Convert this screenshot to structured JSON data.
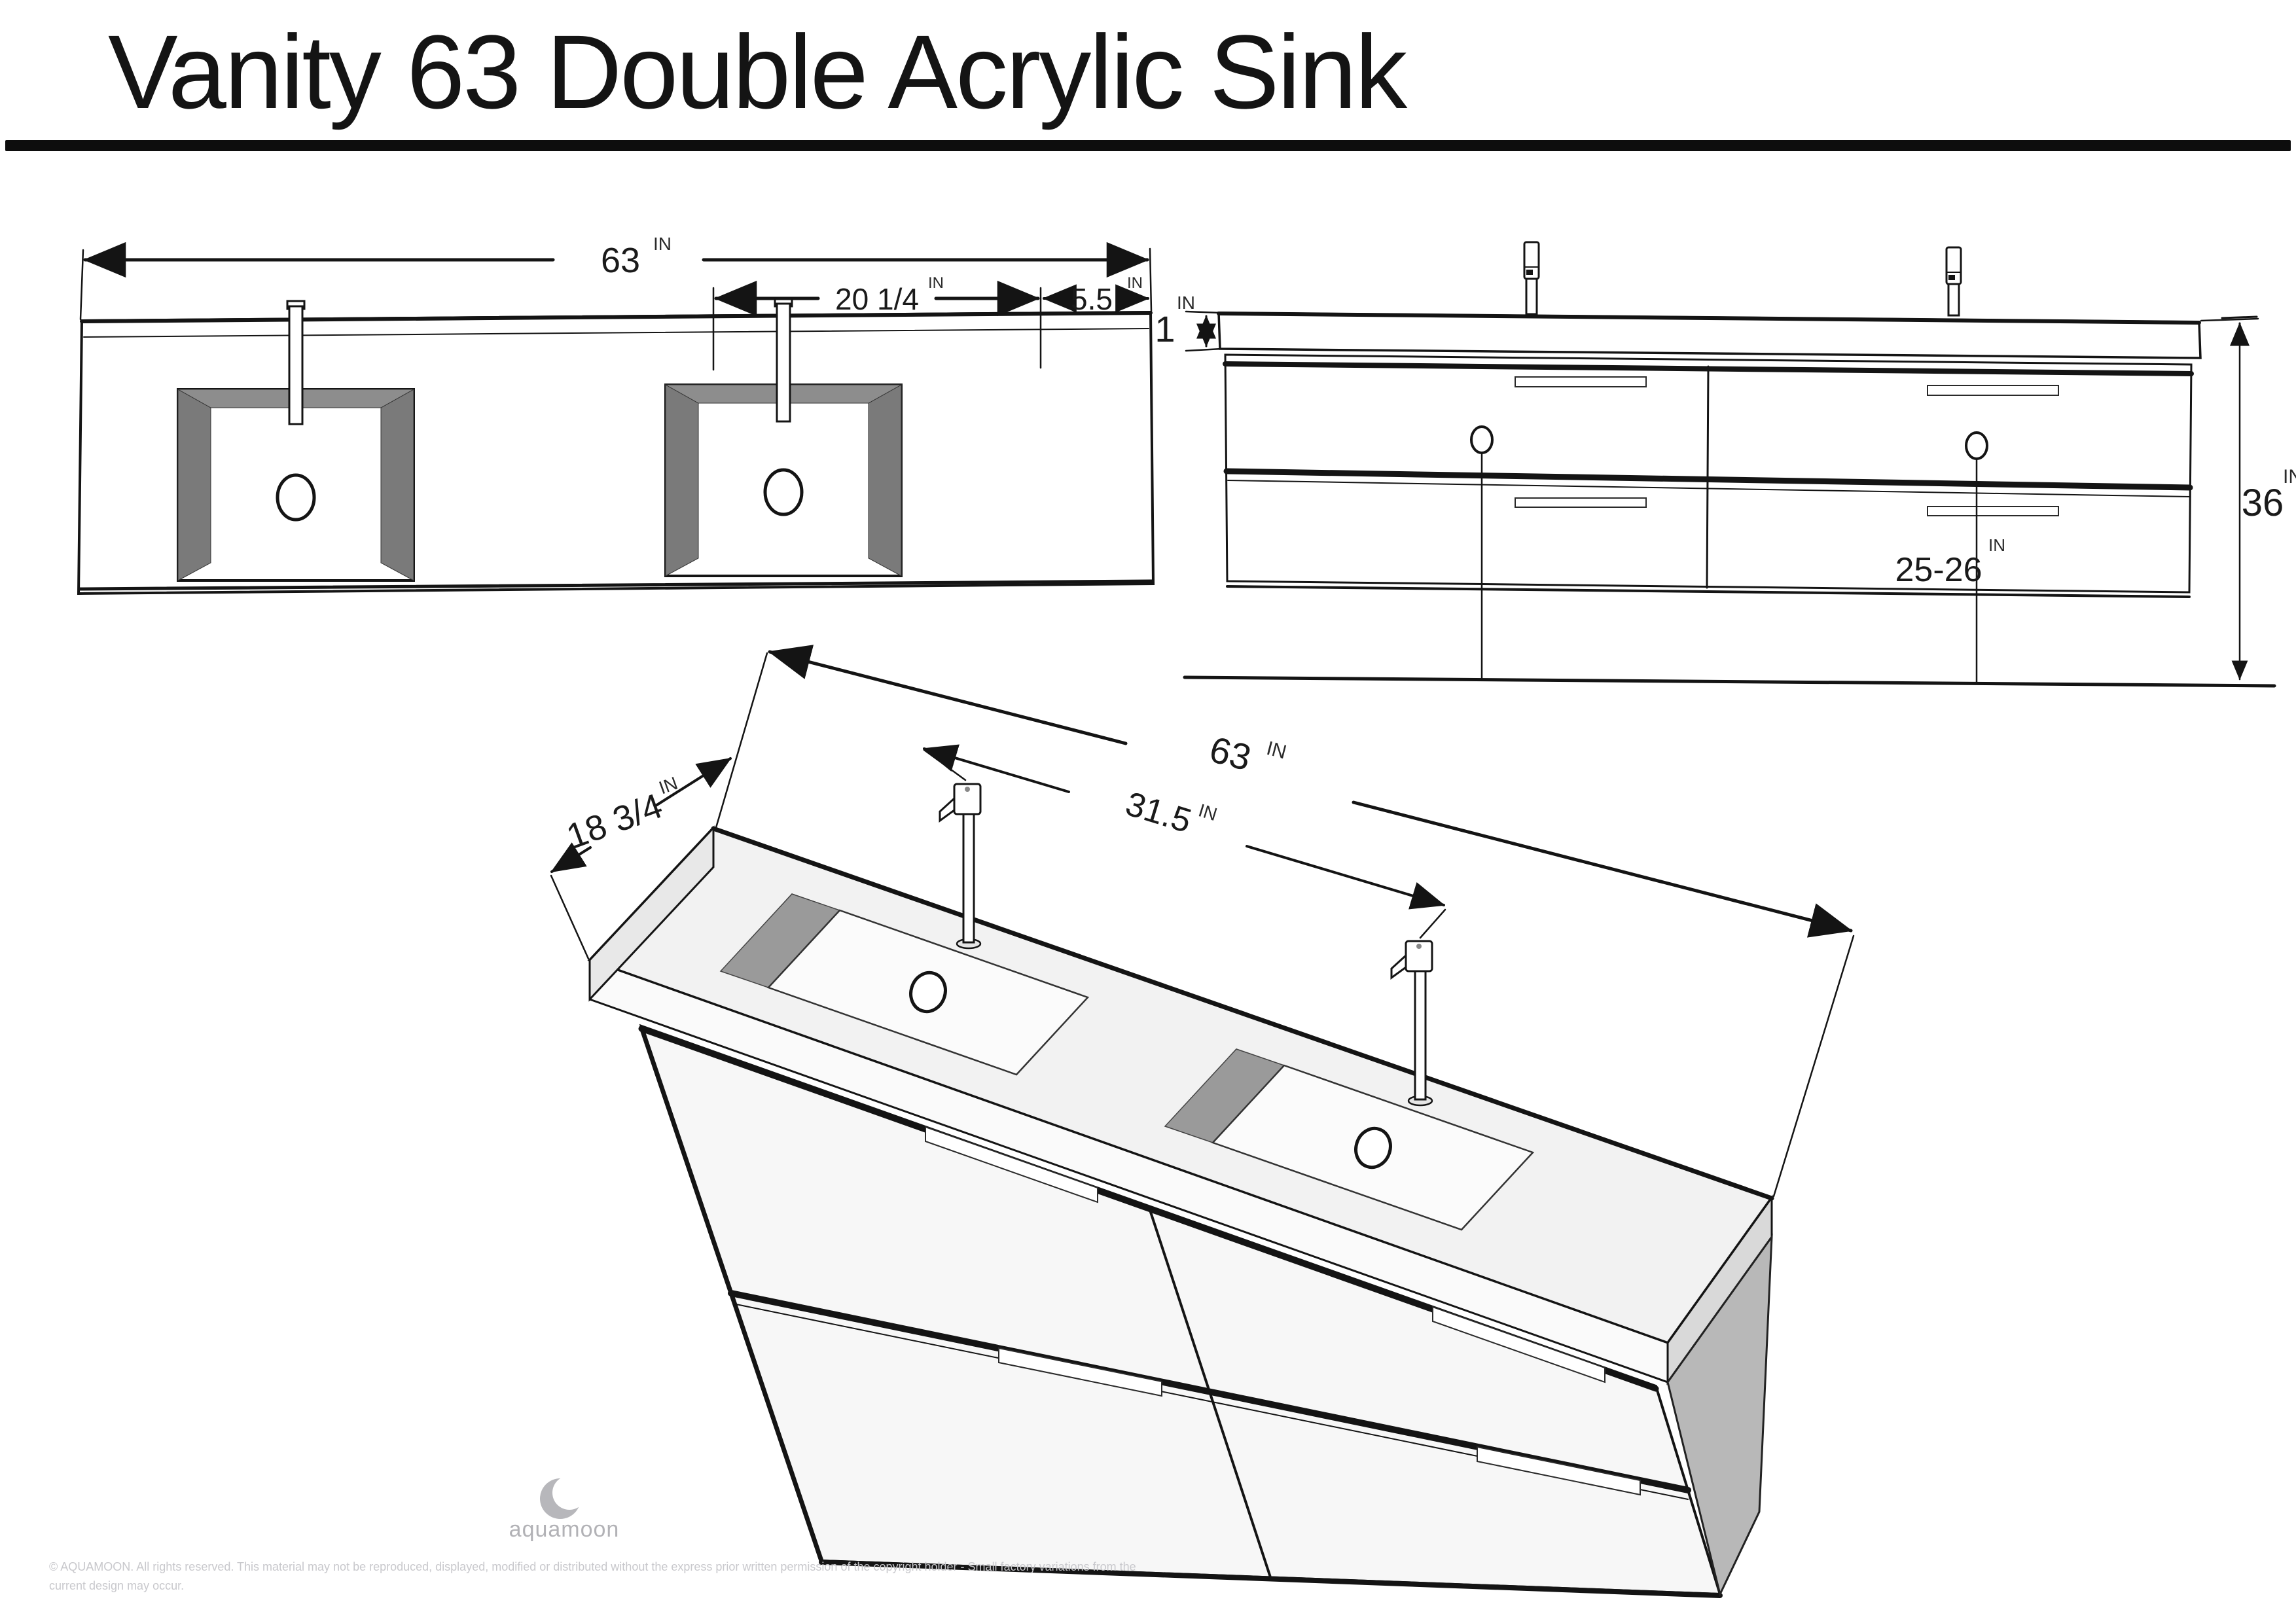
{
  "title": "Vanity 63 Double Acrylic Sink",
  "unit": "IN",
  "top_view": {
    "width": "63",
    "basin_width": "20 1/4",
    "edge_offset": "5.5"
  },
  "front_view": {
    "counter_thickness": "1",
    "height": "36",
    "drain_height": "25-26"
  },
  "perspective_view": {
    "width": "63",
    "depth": "18 3/4",
    "faucet_spacing": "31.5"
  },
  "footer": {
    "brand": "aquamoon",
    "copyright": "© AQUAMOON. All rights reserved. This material may not be reproduced, displayed, modified or distributed without the express prior written permission of the copyright holder - Small factory variations from the current design may occur."
  },
  "colors": {
    "line": "#141414",
    "basin_wall_gray": "#7a7a7a",
    "panel_gray": "#b8b8b8",
    "surface_light": "#f2f2f2",
    "logo_gray": "#b7b7bb"
  }
}
